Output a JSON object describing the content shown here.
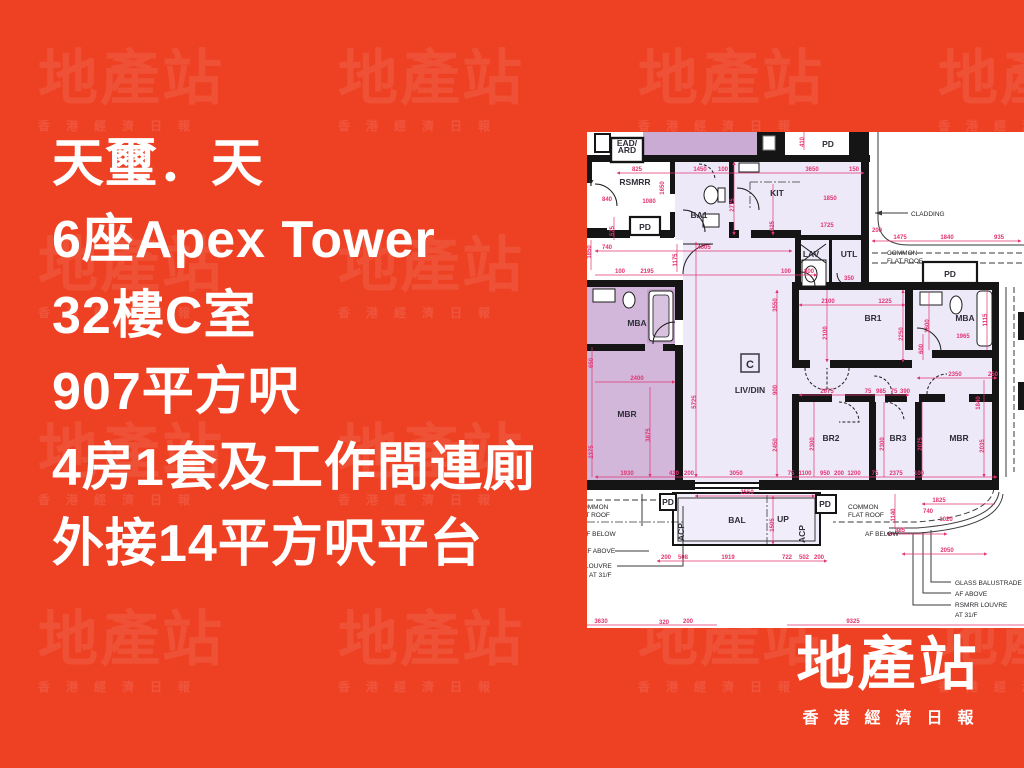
{
  "colors": {
    "background": "#EE4124",
    "headline_text": "#FFFFFF",
    "plan_dim": "#E23472",
    "plan_wall": "#151515",
    "room_light": "#EDE9F8",
    "room_shaded": "#D2B7DA",
    "room_shaded_dark": "#C3A3CC"
  },
  "headline": {
    "lines": [
      "天璽．天",
      "6座Apex Tower",
      "32樓C室",
      "907平方呎",
      "4房1套及工作間連廁",
      "外接14平方呎平台"
    ]
  },
  "watermark": {
    "title": "地產站",
    "subtitle": "香港經濟日報"
  },
  "logo": {
    "title": "地產站",
    "subtitle": "香港經濟日報"
  },
  "floorplan": {
    "unit_label": "C",
    "rooms": [
      {
        "t": "EAD/",
        "x": 40,
        "y": 14,
        "fs": 6.2
      },
      {
        "t": "ARD",
        "x": 40,
        "y": 21,
        "fs": 6.2
      },
      {
        "t": "RSMRR",
        "x": 48,
        "y": 53,
        "fs": 8
      },
      {
        "t": "Y",
        "x": 4,
        "y": 54,
        "fs": 8
      },
      {
        "t": "PD",
        "x": 58,
        "y": 98,
        "fs": 7
      },
      {
        "t": "BA1",
        "x": 112,
        "y": 86,
        "fs": 8
      },
      {
        "t": "KIT",
        "x": 190,
        "y": 64,
        "fs": 8
      },
      {
        "t": "LAV",
        "x": 224,
        "y": 125,
        "fs": 8
      },
      {
        "t": "UTL",
        "x": 262,
        "y": 125,
        "fs": 8
      },
      {
        "t": "PD",
        "x": 241,
        "y": 15,
        "fs": 6.5
      },
      {
        "t": "PD",
        "x": 363,
        "y": 145,
        "fs": 7
      },
      {
        "t": "MBA",
        "x": 50,
        "y": 194
      },
      {
        "t": "MBR",
        "x": 40,
        "y": 285
      },
      {
        "t": "LIV/DIN",
        "x": 163,
        "y": 261
      },
      {
        "t": "BR1",
        "x": 286,
        "y": 189
      },
      {
        "t": "MBA",
        "x": 378,
        "y": 189
      },
      {
        "t": "BR2",
        "x": 244,
        "y": 309
      },
      {
        "t": "BR3",
        "x": 311,
        "y": 309
      },
      {
        "t": "MBR",
        "x": 372,
        "y": 309
      },
      {
        "t": "BAL",
        "x": 150,
        "y": 391,
        "fs": 8
      },
      {
        "t": "UP",
        "x": 196,
        "y": 390,
        "fs": 7
      },
      {
        "t": "ACP",
        "x": 97,
        "y": 400,
        "rot": 1,
        "fs": 6.5
      },
      {
        "t": "ACP",
        "x": 218,
        "y": 402,
        "rot": 1,
        "fs": 6.5
      },
      {
        "t": "PD",
        "x": 81,
        "y": 373,
        "fs": 6
      },
      {
        "t": "PD",
        "x": 238,
        "y": 375,
        "fs": 6
      }
    ],
    "annotations": [
      {
        "t": "CLADDING",
        "x": 324,
        "y": 84
      },
      {
        "t": "COMMON",
        "x": 300,
        "y": 123
      },
      {
        "t": "FLAT ROOF",
        "x": 300,
        "y": 131
      },
      {
        "t": "COMMON",
        "x": 261,
        "y": 377
      },
      {
        "t": "FLAT ROOF",
        "x": 261,
        "y": 385
      },
      {
        "t": "COMMON",
        "x": -9,
        "y": 377
      },
      {
        "t": "FLAT ROOF",
        "x": -13,
        "y": 385
      },
      {
        "t": "AF BELOW",
        "x": 278,
        "y": 404
      },
      {
        "t": "AF BELOW",
        "x": -5,
        "y": 404
      },
      {
        "t": "AF ABOVE",
        "x": -4,
        "y": 421
      },
      {
        "t": "LOUVRE",
        "x": -2,
        "y": 436
      },
      {
        "t": "AT 31/F",
        "x": 2,
        "y": 445
      },
      {
        "t": "GLASS BALUSTRADE",
        "x": 368,
        "y": 453
      },
      {
        "t": "AF ABOVE",
        "x": 368,
        "y": 464
      },
      {
        "t": "RSMRR LOUVRE",
        "x": 368,
        "y": 475
      },
      {
        "t": "AT 31/F",
        "x": 368,
        "y": 485
      }
    ],
    "dims": [
      {
        "t": "825",
        "x": 50,
        "y": 39
      },
      {
        "t": "1450",
        "x": 113,
        "y": 39
      },
      {
        "t": "100",
        "x": 136,
        "y": 39
      },
      {
        "t": "3650",
        "x": 225,
        "y": 39
      },
      {
        "t": "150",
        "x": 267,
        "y": 39
      },
      {
        "t": "840",
        "x": 20,
        "y": 69
      },
      {
        "t": "1080",
        "x": 62,
        "y": 71
      },
      {
        "t": "1850",
        "x": 243,
        "y": 68
      },
      {
        "t": "1725",
        "x": 240,
        "y": 95
      },
      {
        "t": "740",
        "x": 20,
        "y": 117
      },
      {
        "t": "4605",
        "x": 117,
        "y": 117
      },
      {
        "t": "100",
        "x": 33,
        "y": 141
      },
      {
        "t": "2195",
        "x": 60,
        "y": 141
      },
      {
        "t": "100",
        "x": 199,
        "y": 141
      },
      {
        "t": "800",
        "x": 222,
        "y": 141
      },
      {
        "t": "350",
        "x": 262,
        "y": 148
      },
      {
        "t": "1475",
        "x": 313,
        "y": 107
      },
      {
        "t": "1840",
        "x": 360,
        "y": 107
      },
      {
        "t": "935",
        "x": 412,
        "y": 107
      },
      {
        "t": "200",
        "x": 290,
        "y": 100
      },
      {
        "t": "2100",
        "x": 241,
        "y": 171
      },
      {
        "t": "1225",
        "x": 298,
        "y": 171
      },
      {
        "t": "1965",
        "x": 376,
        "y": 206
      },
      {
        "t": "2350",
        "x": 368,
        "y": 244
      },
      {
        "t": "250",
        "x": 406,
        "y": 244
      },
      {
        "t": "2075",
        "x": 240,
        "y": 261
      },
      {
        "t": "75",
        "x": 281,
        "y": 261
      },
      {
        "t": "985",
        "x": 294,
        "y": 261
      },
      {
        "t": "75",
        "x": 307,
        "y": 261
      },
      {
        "t": "390",
        "x": 318,
        "y": 261
      },
      {
        "t": "2400",
        "x": 50,
        "y": 248
      },
      {
        "t": "1930",
        "x": 40,
        "y": 343
      },
      {
        "t": "420",
        "x": 87,
        "y": 343
      },
      {
        "t": "200",
        "x": 102,
        "y": 343
      },
      {
        "t": "3050",
        "x": 149,
        "y": 343
      },
      {
        "t": "75",
        "x": 204,
        "y": 343
      },
      {
        "t": "1100",
        "x": 218,
        "y": 343
      },
      {
        "t": "950",
        "x": 238,
        "y": 343
      },
      {
        "t": "200",
        "x": 252,
        "y": 343
      },
      {
        "t": "1200",
        "x": 267,
        "y": 343
      },
      {
        "t": "75",
        "x": 288,
        "y": 343
      },
      {
        "t": "2375",
        "x": 309,
        "y": 343
      },
      {
        "t": "100",
        "x": 332,
        "y": 343
      },
      {
        "t": "2550",
        "x": 160,
        "y": 362
      },
      {
        "t": "1825",
        "x": 352,
        "y": 370
      },
      {
        "t": "740",
        "x": 341,
        "y": 381
      },
      {
        "t": "1020",
        "x": 359,
        "y": 389
      },
      {
        "t": "885",
        "x": 313,
        "y": 400
      },
      {
        "t": "2050",
        "x": 360,
        "y": 420
      },
      {
        "t": "200",
        "x": 79,
        "y": 427
      },
      {
        "t": "508",
        "x": 96,
        "y": 427
      },
      {
        "t": "1919",
        "x": 141,
        "y": 427
      },
      {
        "t": "722",
        "x": 200,
        "y": 427
      },
      {
        "t": "502",
        "x": 217,
        "y": 427
      },
      {
        "t": "200",
        "x": 232,
        "y": 427
      },
      {
        "t": "3630",
        "x": 14,
        "y": 491
      },
      {
        "t": "320",
        "x": 77,
        "y": 492
      },
      {
        "t": "200",
        "x": 101,
        "y": 491
      },
      {
        "t": "9325",
        "x": 266,
        "y": 491
      },
      {
        "t": "2775",
        "x": 147,
        "y": 73,
        "rot": 1
      },
      {
        "t": "625",
        "x": 187,
        "y": 94,
        "rot": 1
      },
      {
        "t": "575",
        "x": 27,
        "y": 99,
        "rot": 1
      },
      {
        "t": "1650",
        "x": 77,
        "y": 56,
        "rot": 1
      },
      {
        "t": "1850",
        "x": 4,
        "y": 120,
        "rot": 1
      },
      {
        "t": "1175",
        "x": 90,
        "y": 128,
        "rot": 1
      },
      {
        "t": "3550",
        "x": 190,
        "y": 173,
        "rot": 1
      },
      {
        "t": "900",
        "x": 190,
        "y": 258,
        "rot": 1
      },
      {
        "t": "2450",
        "x": 190,
        "y": 313,
        "rot": 1
      },
      {
        "t": "5725",
        "x": 109,
        "y": 270,
        "rot": 1
      },
      {
        "t": "2250",
        "x": 316,
        "y": 202,
        "rot": 1
      },
      {
        "t": "2100",
        "x": 240,
        "y": 201,
        "rot": 1
      },
      {
        "t": "1600",
        "x": 342,
        "y": 194,
        "rot": 1
      },
      {
        "t": "1115",
        "x": 400,
        "y": 188,
        "rot": 1
      },
      {
        "t": "600",
        "x": 336,
        "y": 217,
        "rot": 1
      },
      {
        "t": "3875",
        "x": 63,
        "y": 303,
        "rot": 1
      },
      {
        "t": "2375",
        "x": 6,
        "y": 320,
        "rot": 1
      },
      {
        "t": "650",
        "x": 6,
        "y": 231,
        "rot": 1
      },
      {
        "t": "2300",
        "x": 227,
        "y": 312,
        "rot": 1
      },
      {
        "t": "2300",
        "x": 297,
        "y": 312,
        "rot": 1
      },
      {
        "t": "2075",
        "x": 335,
        "y": 312,
        "rot": 1
      },
      {
        "t": "2035",
        "x": 397,
        "y": 314,
        "rot": 1
      },
      {
        "t": "1840",
        "x": 393,
        "y": 271,
        "rot": 1
      },
      {
        "t": "1505",
        "x": 187,
        "y": 393,
        "rot": 1
      },
      {
        "t": "410",
        "x": 217,
        "y": 10,
        "rot": 1
      },
      {
        "t": "1140",
        "x": 308,
        "y": 383,
        "rot": 1
      }
    ]
  }
}
